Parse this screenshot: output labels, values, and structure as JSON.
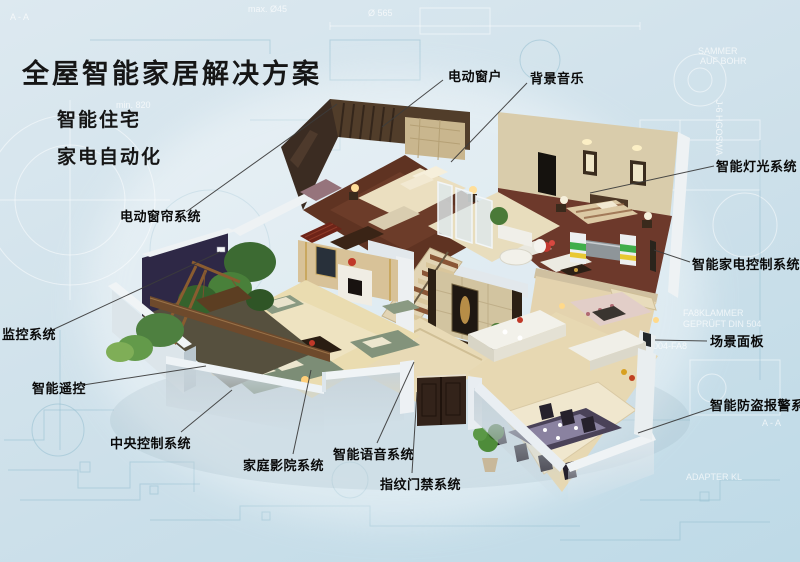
{
  "title": "全屋智能家居解决方案",
  "subtitles": [
    "智能住宅",
    "家电自动化"
  ],
  "colors": {
    "bg-top": "#dde9f0",
    "bg-mid": "#cde0ea",
    "bg-bot": "#bedae7",
    "title": "#161616",
    "label": "#0a0a0a",
    "line": "#3c3c3c",
    "blueprint-line": "#8fbccd",
    "wall-white": "#eef2f4",
    "wall-shadow": "#c7d3da",
    "floor-beige": "#e7d8b2",
    "wood-dark": "#5f3322",
    "sofa-green": "#7e8f77",
    "plant-green": "#4e7c38"
  },
  "callouts": [
    {
      "slug": "electric-window",
      "text": "电动窗户",
      "x": 448,
      "y": 66,
      "line": [
        443,
        80,
        382,
        127
      ]
    },
    {
      "slug": "background-music",
      "text": "背景音乐",
      "x": 530,
      "y": 68,
      "line": [
        527,
        83,
        451,
        162
      ]
    },
    {
      "slug": "smart-lighting-system",
      "text": "智能灯光系统",
      "x": 716,
      "y": 156,
      "line": [
        714,
        166,
        590,
        193
      ]
    },
    {
      "slug": "smart-appliance-control-system",
      "text": "智能家电控制系统",
      "x": 692,
      "y": 254,
      "line": [
        690,
        262,
        654,
        250
      ]
    },
    {
      "slug": "scene-panel",
      "text": "场景面板",
      "x": 710,
      "y": 331,
      "line": [
        707,
        341,
        655,
        340
      ]
    },
    {
      "slug": "smart-burglar-alarm-system",
      "text": "智能防盗报警系统",
      "x": 710,
      "y": 395,
      "line": [
        712,
        408,
        638,
        433
      ]
    },
    {
      "slug": "electric-curtain-system",
      "text": "电动窗帘系统",
      "x": 120,
      "y": 206,
      "line": [
        186,
        212,
        337,
        104
      ]
    },
    {
      "slug": "surveillance-system",
      "text": "监控系统",
      "x": 2,
      "y": 324,
      "line": [
        50,
        331,
        220,
        252
      ]
    },
    {
      "slug": "smart-remote-control",
      "text": "智能遥控",
      "x": 32,
      "y": 378,
      "line": [
        83,
        385,
        206,
        366
      ]
    },
    {
      "slug": "central-control-system",
      "text": "中央控制系统",
      "x": 110,
      "y": 433,
      "line": [
        181,
        432,
        232,
        390
      ]
    },
    {
      "slug": "home-theater-system",
      "text": "家庭影院系统",
      "x": 243,
      "y": 455,
      "line": [
        293,
        454,
        311,
        370
      ]
    },
    {
      "slug": "smart-voice-system",
      "text": "智能语音系统",
      "x": 333,
      "y": 444,
      "line": [
        377,
        443,
        414,
        362
      ]
    },
    {
      "slug": "fingerprint-access-system",
      "text": "指纹门禁系统",
      "x": 380,
      "y": 474,
      "line": [
        412,
        473,
        417,
        392
      ]
    }
  ],
  "background": {
    "texts": [
      {
        "text": "A - A",
        "x": 10,
        "y": 20
      },
      {
        "text": "max. Ø45",
        "x": 248,
        "y": 12
      },
      {
        "text": "Ø 565",
        "x": 368,
        "y": 16
      },
      {
        "text": "min. 820",
        "x": 116,
        "y": 108
      },
      {
        "text": "SAMMER",
        "x": 698,
        "y": 54
      },
      {
        "text": "AUF BOHR",
        "x": 700,
        "y": 64
      },
      {
        "text": "J-6 HGOSWA",
        "x": 716,
        "y": 100,
        "rotate": 90
      },
      {
        "text": "FA8KLAMMER",
        "x": 683,
        "y": 316
      },
      {
        "text": "GEPRÜFT DIN 504",
        "x": 683,
        "y": 327
      },
      {
        "text": "2004-FA8",
        "x": 648,
        "y": 349
      },
      {
        "text": "A - A",
        "x": 762,
        "y": 426
      },
      {
        "text": "ADAPTER KL",
        "x": 686,
        "y": 480
      }
    ]
  }
}
